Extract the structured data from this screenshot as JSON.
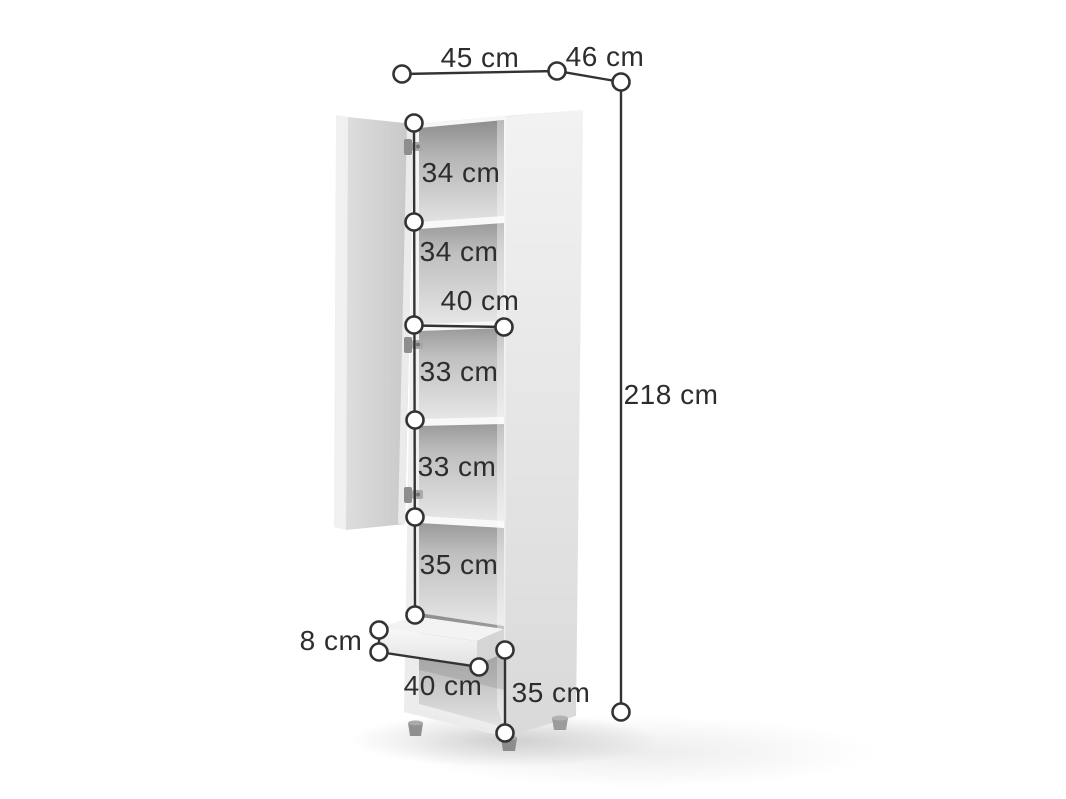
{
  "diagram": {
    "subject": "Tall cabinet dimension diagram",
    "description": "White tall storage cabinet shown with open left door, five shelf compartments, a pull-out drawer and an open bottom compartment, annotated with measurements",
    "line_color": "#333333",
    "label_color": "#2d2d2d",
    "cabinet_color": "#e9e9e9",
    "door_color": "#d2d2d2"
  },
  "dimensions": {
    "top_width": "45 cm",
    "top_depth": "46 cm",
    "total_height": "218 cm",
    "compartment_1_height": "34 cm",
    "compartment_2_height": "34 cm",
    "inner_width": "40 cm",
    "compartment_3_height": "33 cm",
    "compartment_4_height": "33 cm",
    "compartment_5_height": "35 cm",
    "drawer_front_height": "8 cm",
    "bottom_inner_width": "40 cm",
    "bottom_compartment_height": "35 cm"
  }
}
